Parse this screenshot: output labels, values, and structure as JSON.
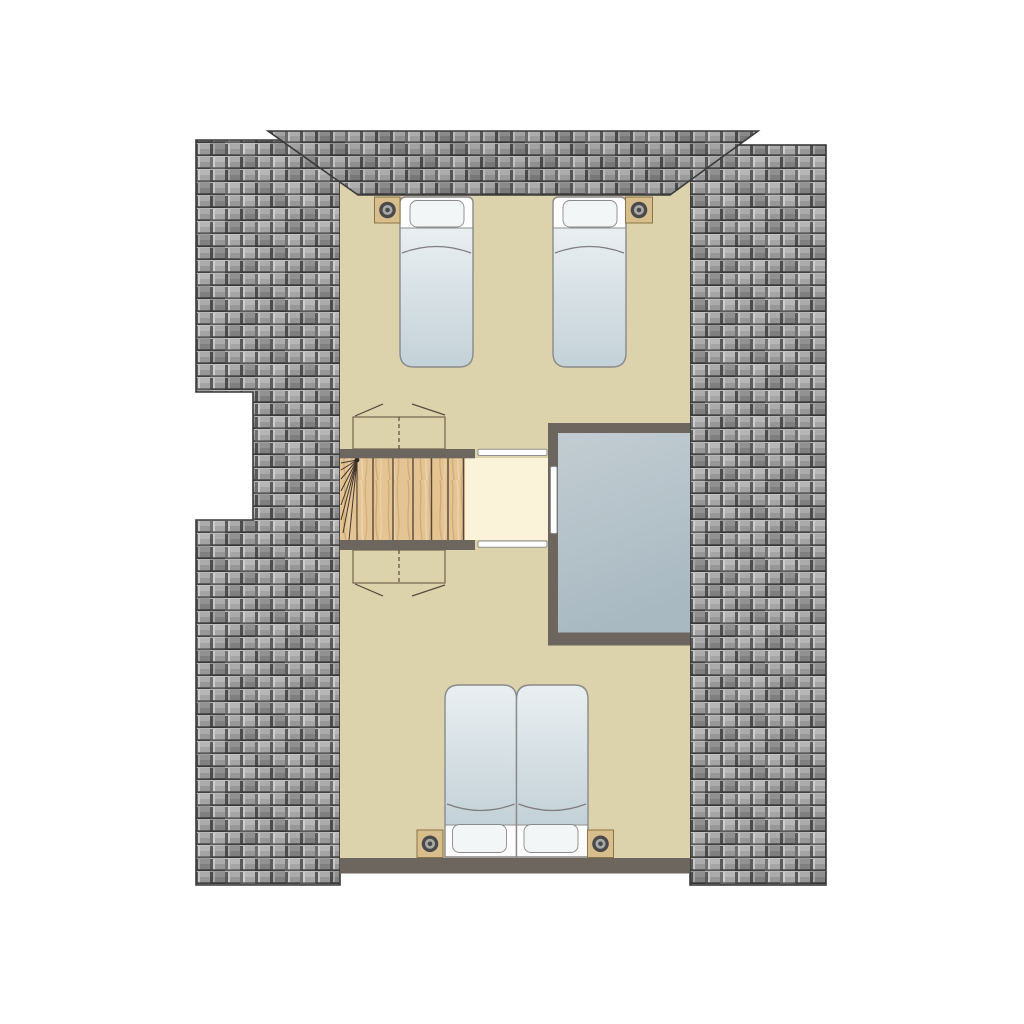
{
  "scene": {
    "type": "architectural-floor-plan",
    "floor": "attic-level",
    "description": "Top-down attic floor plan: two single beds at top, one double bed (two mattresses) at bottom, winder staircase with landing, stairwell void open to below, surrounded by tiled roof slopes with a dormer roof at top"
  },
  "colors": {
    "page_background": "#ffffff",
    "room_floor": "#dcd2ac",
    "landing_floor": "#faf3d9",
    "wall": "#6c665f",
    "roof_outline": "#3a3a3a",
    "tile_face": "#9b9b9b",
    "tile_face_light": "#ababab",
    "tile_face_lower": "#979797",
    "tile_groove": "#5a5a5a",
    "tile_highlight": "#c6c6c6",
    "tile_gap": "#424242",
    "tile_top": "#b8b8b8",
    "stair_wood": "#e5c493",
    "panel_wood": "#f1e0ac",
    "wood_line": "#55483a",
    "void_light": "#c2cdd2",
    "void_dark": "#a9b9c2",
    "bed_base": "#fdfdfd",
    "bed_blanket_light": "#e9eff1",
    "bed_blanket_dark": "#c3d1d8",
    "pillow": "#f3f6f6",
    "bed_border": "#8a8a8a",
    "fixture_base": "#d9be8d",
    "fixture_ring": "#4a4a4a",
    "fixture_ring_mid": "#a9a9a9",
    "railing_fill": "#ffffff"
  },
  "elements": {
    "roof_sections": [
      "left-roof-slope",
      "right-roof-slope",
      "dormer-roof-top"
    ],
    "rooms": [
      "attic-bedroom",
      "stair-landing",
      "stairwell-void"
    ],
    "beds": [
      {
        "kind": "single-bed",
        "position": "top-left",
        "pillow_end": "top"
      },
      {
        "kind": "single-bed",
        "position": "top-right",
        "pillow_end": "top"
      },
      {
        "kind": "double-bed-left-mattress",
        "position": "bottom",
        "pillow_end": "bottom"
      },
      {
        "kind": "double-bed-right-mattress",
        "position": "bottom",
        "pillow_end": "bottom"
      }
    ],
    "ceiling_spots": 4,
    "staircase": {
      "straight_treads": 6,
      "winder_fan_lines": 8,
      "landing": true
    },
    "railings": 3,
    "knee_wall_panels": 2
  }
}
